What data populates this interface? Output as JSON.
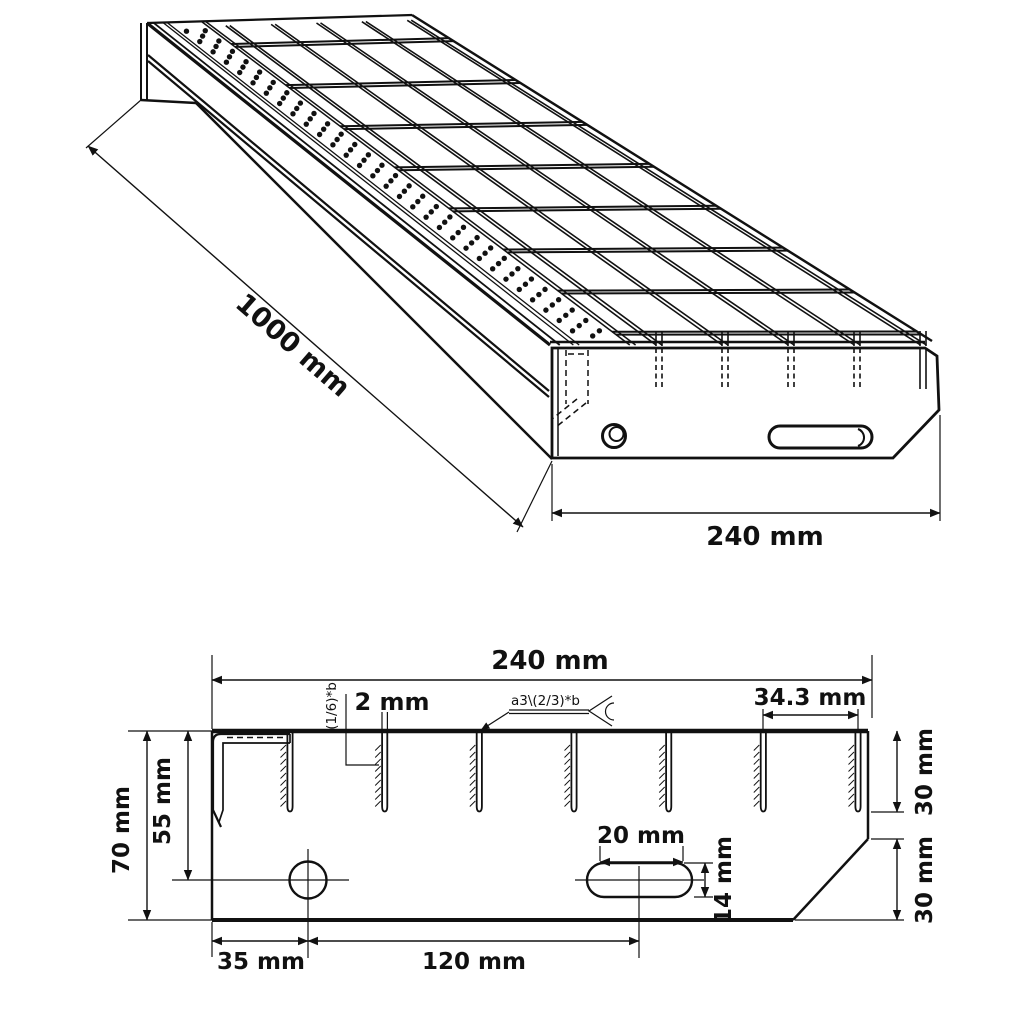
{
  "page": {
    "background": "#ffffff",
    "line_color": "#111111"
  },
  "isometric_view": {
    "length_dim": "1000 mm",
    "width_dim": "240 mm"
  },
  "section_view": {
    "overall_width_dim": "240 mm",
    "overall_height_dim": "70 mm",
    "nosing_height_dim": "55 mm",
    "bar_thickness_dim": "2 mm",
    "bar_thickness_note": "(1/6)*b",
    "weld_spec": "a3\\(2/3)*b",
    "bar_spacing_dim": "34.3 mm",
    "bar_height_dim": "30 mm",
    "chamfer_height_dim": "30 mm",
    "hole_offset_dim": "35 mm",
    "hole_to_slot_dim": "120 mm",
    "slot_length_dim": "20 mm",
    "slot_height_dim": "14 mm"
  },
  "drawing": {
    "type": "technical-drawing",
    "subject": "steel grating stair tread",
    "views": [
      "isometric view",
      "cross-section view"
    ],
    "bearing_bar_count_section": 7,
    "hidden_bar_stub_count": 5
  }
}
